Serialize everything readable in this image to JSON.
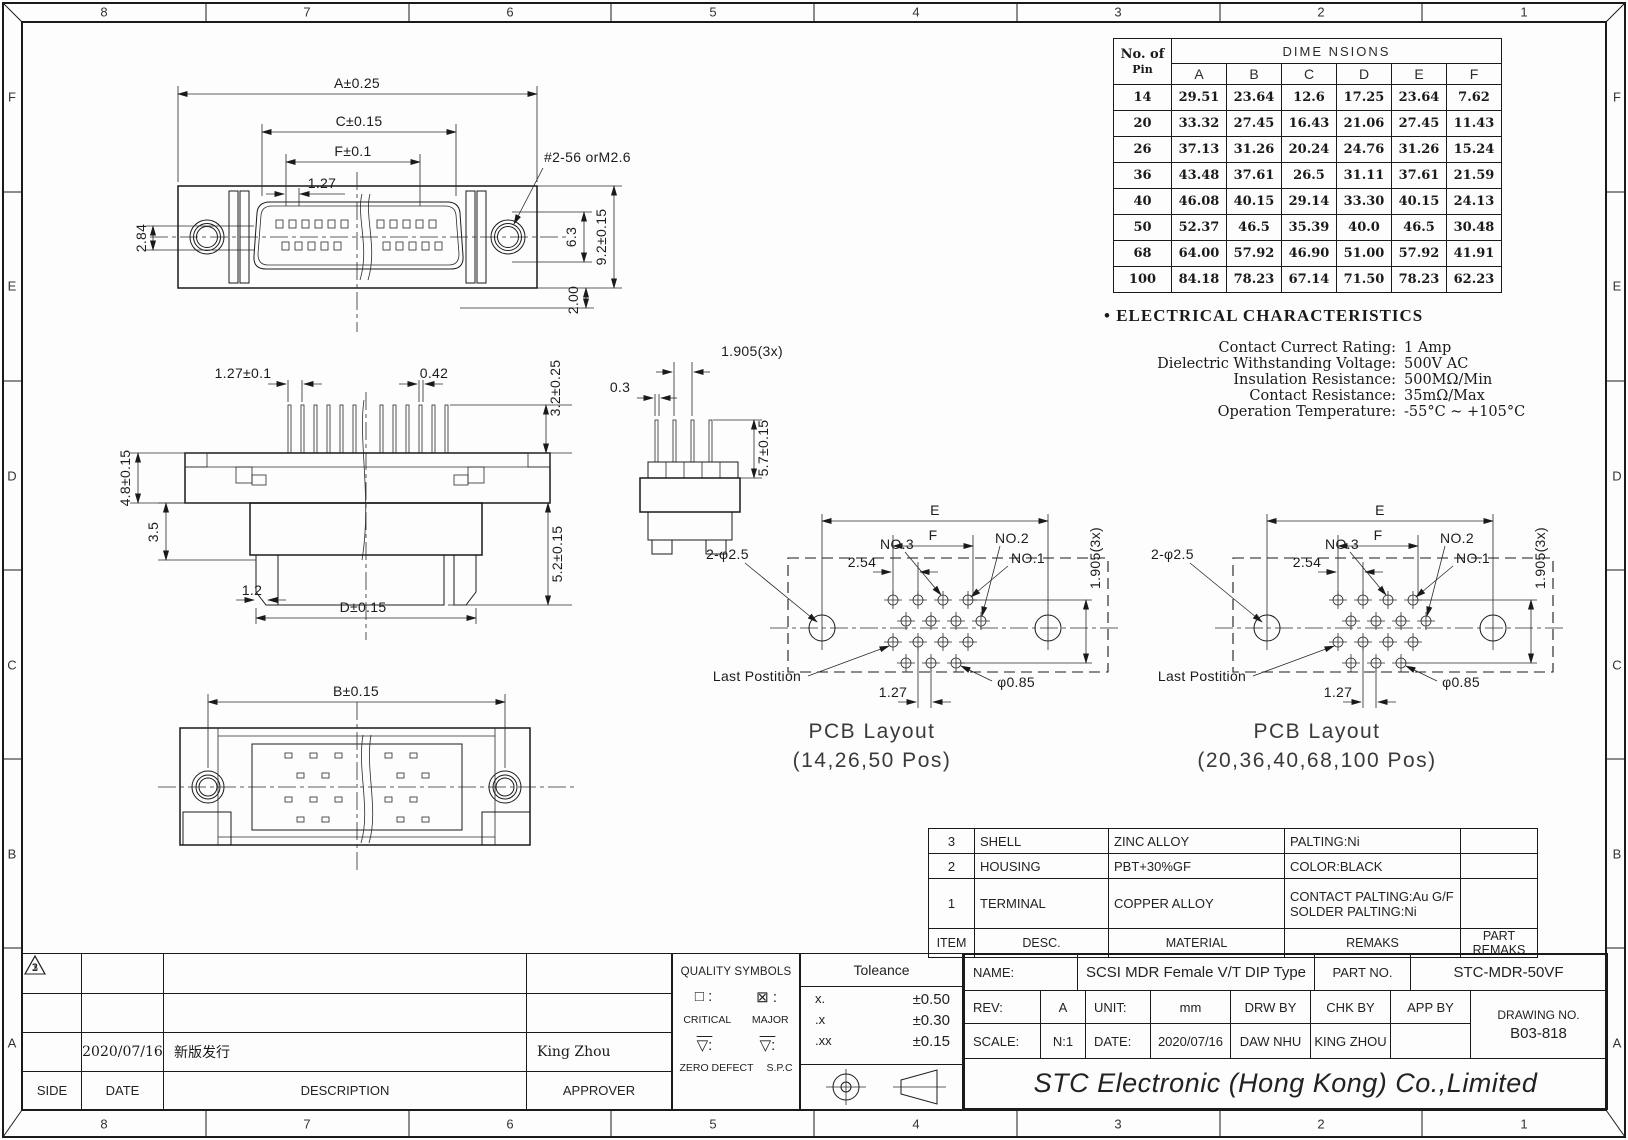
{
  "border": {
    "cols": [
      "8",
      "7",
      "6",
      "5",
      "4",
      "3",
      "2",
      "1"
    ],
    "rows": [
      "F",
      "E",
      "D",
      "C",
      "B",
      "A"
    ]
  },
  "dims_table": {
    "pin_header_1": "No. of",
    "pin_header_2": "Pin",
    "dims_header": "DIME NSIONS",
    "cols": [
      "A",
      "B",
      "C",
      "D",
      "E",
      "F"
    ],
    "r": [
      {
        "p": "14",
        "v": [
          "29.51",
          "23.64",
          "12.6",
          "17.25",
          "23.64",
          "7.62"
        ]
      },
      {
        "p": "20",
        "v": [
          "33.32",
          "27.45",
          "16.43",
          "21.06",
          "27.45",
          "11.43"
        ]
      },
      {
        "p": "26",
        "v": [
          "37.13",
          "31.26",
          "20.24",
          "24.76",
          "31.26",
          "15.24"
        ]
      },
      {
        "p": "36",
        "v": [
          "43.48",
          "37.61",
          "26.5",
          "31.11",
          "37.61",
          "21.59"
        ]
      },
      {
        "p": "40",
        "v": [
          "46.08",
          "40.15",
          "29.14",
          "33.30",
          "40.15",
          "24.13"
        ]
      },
      {
        "p": "50",
        "v": [
          "52.37",
          "46.5",
          "35.39",
          "40.0",
          "46.5",
          "30.48"
        ]
      },
      {
        "p": "68",
        "v": [
          "64.00",
          "57.92",
          "46.90",
          "51.00",
          "57.92",
          "41.91"
        ]
      },
      {
        "p": "100",
        "v": [
          "84.18",
          "78.23",
          "67.14",
          "71.50",
          "78.23",
          "62.23"
        ]
      }
    ]
  },
  "electrical": {
    "title": "ELECTRICAL CHARACTERISTICS",
    "items": [
      {
        "label": "Contact Currect Rating:",
        "value": "1 Amp"
      },
      {
        "label": "Dielectric Withstanding Voltage:",
        "value": "500V AC"
      },
      {
        "label": "Insulation Resistance:",
        "value": "500MΩ/Min"
      },
      {
        "label": "Contact Resistance:",
        "value": "35mΩ/Max"
      },
      {
        "label": "Operation Temperature:",
        "value": "-55°C ~ +105°C"
      }
    ]
  },
  "materials": {
    "headers": {
      "item": "ITEM",
      "desc": "DESC.",
      "material": "MATERIAL",
      "remarks": "REMAKS",
      "part_remarks": "PART REMAKS"
    },
    "rows": [
      {
        "item": "3",
        "desc": "SHELL",
        "material": "ZINC ALLOY",
        "remarks": "PALTING:Ni"
      },
      {
        "item": "2",
        "desc": "HOUSING",
        "material": "PBT+30%GF",
        "remarks": "COLOR:BLACK"
      },
      {
        "item": "1",
        "desc": "TERMINAL",
        "material": "COPPER ALLOY",
        "remarks": "CONTACT PALTING:Au G/F\nSOLDER PALTING:Ni"
      }
    ]
  },
  "title_block": {
    "name_label": "NAME:",
    "name": "SCSI MDR Female V/T DIP Type",
    "part_no_label": "PART NO.",
    "part_no": "STC-MDR-50VF",
    "rev_label": "REV:",
    "rev": "A",
    "unit_label": "UNIT:",
    "unit": "mm",
    "drw_by_label": "DRW BY",
    "chk_by_label": "CHK BY",
    "app_by_label": "APP BY",
    "drawing_no_label": "DRAWING NO.",
    "drawing_no": "B03-818",
    "scale_label": "SCALE:",
    "scale": "N:1",
    "date_label": "DATE:",
    "date": "2020/07/16",
    "drw_by": "DAW NHU",
    "chk_by": "KING ZHOU",
    "app_by": "",
    "company": "STC Electronic (Hong Kong) Co.,Limited"
  },
  "quality": {
    "title": "QUALITY SYMBOLS",
    "critical_sym": "□ :",
    "major_sym": "⊠ :",
    "critical": "CRITICAL",
    "major": "MAJOR",
    "zero_sym": "▽:",
    "spc_sym": "▽:",
    "zero": "ZERO DEFECT",
    "spc": "S.P.C"
  },
  "tolerance": {
    "title": "Toleance",
    "rows": [
      {
        "label": "x.",
        "value": "±0.50"
      },
      {
        "label": ".x",
        "value": "±0.30"
      },
      {
        "label": ".xx",
        "value": "±0.15"
      }
    ]
  },
  "revision": {
    "headers": {
      "side": "SIDE",
      "date": "DATE",
      "description": "DESCRIPTION",
      "approver": "APPROVER"
    },
    "rows": [
      {
        "side": "3",
        "date": "",
        "description": "",
        "approver": ""
      },
      {
        "side": "2",
        "date": "",
        "description": "",
        "approver": ""
      },
      {
        "side": "1",
        "date": "2020/07/16",
        "description": "新版发行",
        "approver": "King Zhou"
      }
    ]
  },
  "views": {
    "front": {
      "dim_a": "A±0.25",
      "dim_c": "C±0.15",
      "dim_f": "F±0.1",
      "p127": "1.27",
      "screw": "#2-56 orM2.6",
      "p284": "2.84",
      "p63": "6.3",
      "p92": "9.2±0.15",
      "p200": "2.00"
    },
    "section": {
      "p127": "1.27±0.1",
      "p042": "0.42",
      "p32": "3.2±0.25",
      "p48": "4.8±0.15",
      "p35": "3.5",
      "p12": "1.2",
      "dim_d": "D±0.15",
      "p52": "5.2±0.15"
    },
    "side": {
      "p03": "0.3",
      "p1905": "1.905(3x)",
      "p57": "5.7±0.15"
    },
    "bottom": {
      "dim_b": "B±0.15"
    },
    "pcb": {
      "e": "E",
      "f": "F",
      "no3": "NO.3",
      "no2": "NO.2",
      "no1": "NO.1",
      "holes": "2-φ2.5",
      "p254": "2.54",
      "p1905": "1.905(3x)",
      "last": "Last Postition",
      "p127": "1.27",
      "dia": "φ0.85",
      "cap": "PCB Layout",
      "sub_left": "(14,26,50 Pos)",
      "sub_right": "(20,36,40,68,100 Pos)"
    }
  }
}
